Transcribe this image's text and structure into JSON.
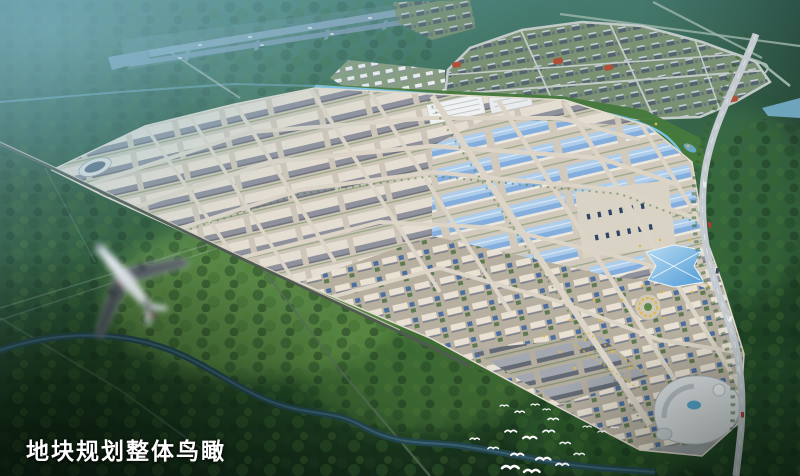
{
  "caption": {
    "text": "地块规划整体鸟瞰",
    "color": "#ffffff"
  },
  "palette": {
    "forest_dark": "#142b18",
    "forest_mid": "#33663a",
    "hill_teal": "#4a8177",
    "haze_blue": "#7fbbd2",
    "runway_blue_grey": "#8aa7bc",
    "park_road": "#dbd4c7",
    "park_ground": "#cdc6b8",
    "roof_light": "#e4ddd1",
    "roof_shadow": "#8f919c",
    "roof_blue": "#aecdeb",
    "roof_blue_deep": "#84aedd",
    "wall_cream": "#ece8df",
    "city_block": "#55636e",
    "city_ground": "#7a9273",
    "sports_field_red": "#b05038",
    "belt_green": "#46793c",
    "stream_blue": "#7cc0e0",
    "river_teal": "#24454f",
    "highway_grey": "#c3cad0",
    "glass_blue": "#4f9ad6",
    "accent_yellow": "#ddb945",
    "mall_white": "#dde1e4",
    "plane_white": "#eef1f4",
    "plane_dark": "#2c3a50",
    "bird_white": "#ffffff"
  }
}
